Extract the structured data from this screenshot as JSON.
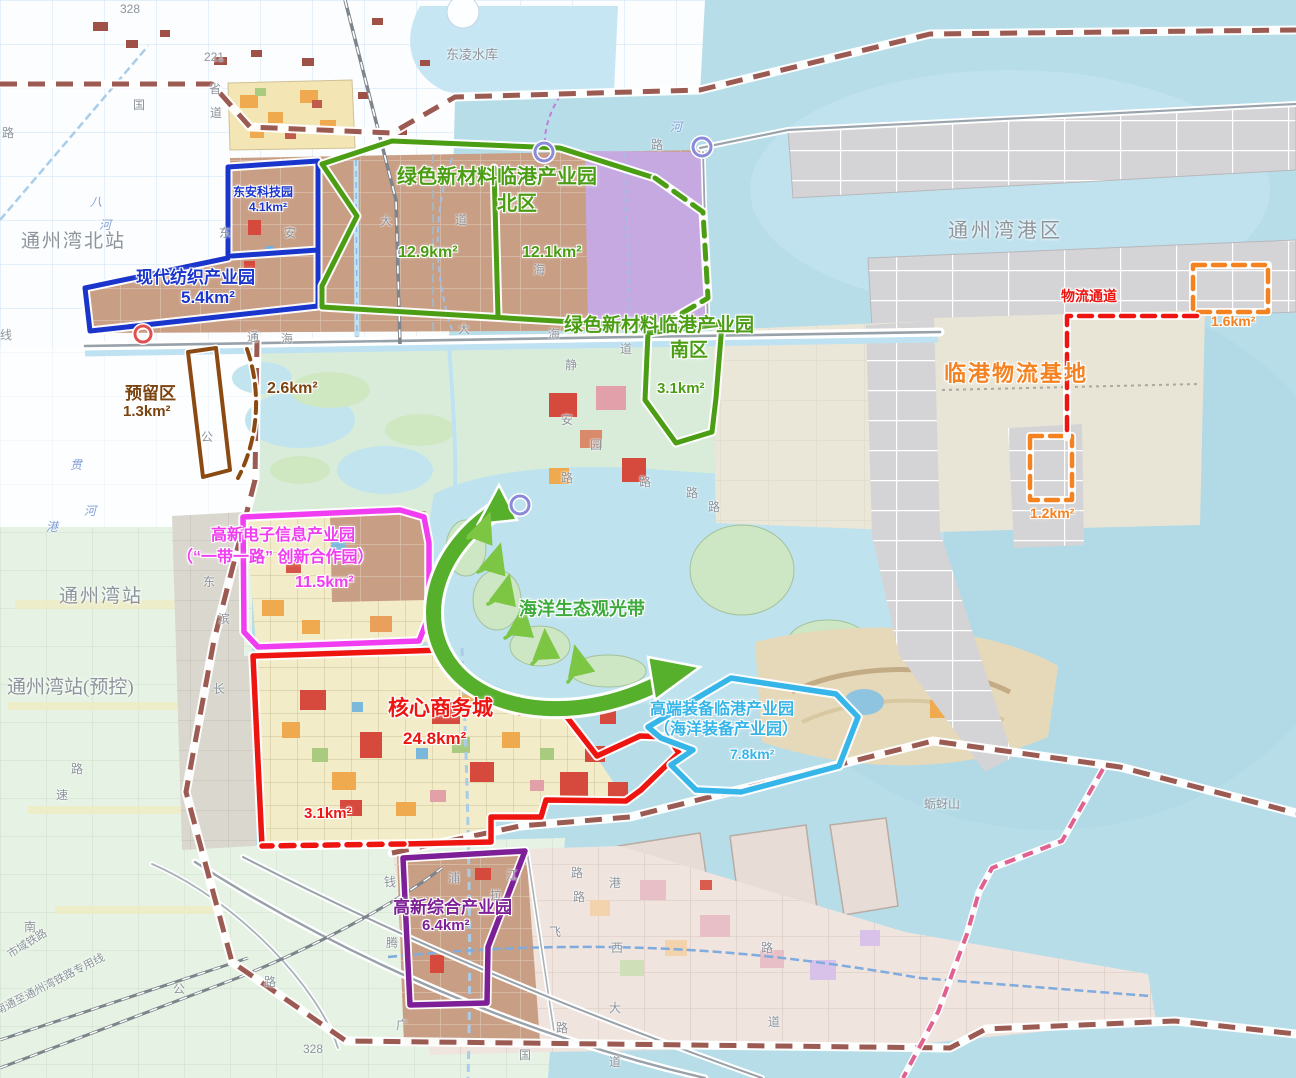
{
  "regions": {
    "dongan": {
      "name": "东安科技园",
      "area": "4.1km²"
    },
    "fangzhi": {
      "name": "现代纺织产业园",
      "area": "5.4km²"
    },
    "lvxin_bei": {
      "name": "绿色新材料临港产业园",
      "sub": "北区",
      "area_west": "12.9km²",
      "area_east": "12.1km²"
    },
    "lvxin_nan": {
      "name": "绿色新材料临港产业园",
      "sub": "南区",
      "area": "3.1km²"
    },
    "yuliu": {
      "name": "预留区",
      "area": "1.3km²",
      "area2": "2.6km²"
    },
    "dianzi": {
      "name": "高新电子信息产业园",
      "sub": "（“一带一路” 创新合作园）",
      "area": "11.5km²"
    },
    "hexin": {
      "name": "核心商务城",
      "area": "24.8km²",
      "area2": "3.1km²"
    },
    "zhuangbei": {
      "name": "高端装备临港产业园",
      "sub": "（海洋装备产业园）",
      "area": "7.8km²"
    },
    "zonghe": {
      "name": "高新综合产业园",
      "area": "6.4km²"
    },
    "wuliu": {
      "name": "临港物流基地",
      "corridor": "物流通道",
      "area_north": "1.6km²",
      "area_south": "1.2km²"
    }
  },
  "places": {
    "tzw_north_station": "通州湾北站",
    "tzw_station": "通州湾站",
    "tzw_station_reserved": "通州湾站(预控)",
    "tzw_port": "通州湾港区",
    "reservoir": "东凌水库",
    "island": "蛎蚜山",
    "belt": "海洋生态观光带"
  },
  "railways": {
    "r1": "市域铁路",
    "r2": "南通至通州湾铁路专用线"
  },
  "palette": {
    "blue": "#1a35cc",
    "green": "#4b9d14",
    "brown": "#8a4a12",
    "magenta": "#f13df1",
    "red": "#ee1511",
    "cyan": "#35b5e8",
    "purple": "#7d1f96",
    "orange": "#f58220",
    "belt_green": "#56b02b",
    "sea": "#b7dde9",
    "industrial_tan": "#c89e85",
    "lavender": "#c7a9e2"
  },
  "road_labels": [
    {
      "t": "328",
      "x": 120,
      "y": 2
    },
    {
      "t": "221",
      "x": 204,
      "y": 50
    },
    {
      "t": "国",
      "x": 133,
      "y": 96
    },
    {
      "t": "省",
      "x": 209,
      "y": 80
    },
    {
      "t": "道",
      "x": 210,
      "y": 104
    },
    {
      "t": "路",
      "x": 2,
      "y": 124
    },
    {
      "t": "线",
      "x": 0,
      "y": 326
    },
    {
      "t": "八",
      "x": 90,
      "y": 193,
      "c": "b"
    },
    {
      "t": "河",
      "x": 99,
      "y": 216,
      "c": "b"
    },
    {
      "t": "通",
      "x": 247,
      "y": 328
    },
    {
      "t": "海",
      "x": 281,
      "y": 330
    },
    {
      "t": "大",
      "x": 458,
      "y": 320
    },
    {
      "t": "海",
      "x": 548,
      "y": 325
    },
    {
      "t": "道",
      "x": 620,
      "y": 340
    },
    {
      "t": "东",
      "x": 219,
      "y": 224
    },
    {
      "t": "安",
      "x": 284,
      "y": 224
    },
    {
      "t": "大",
      "x": 380,
      "y": 212
    },
    {
      "t": "道",
      "x": 455,
      "y": 211
    },
    {
      "t": "海",
      "x": 533,
      "y": 261
    },
    {
      "t": "静",
      "x": 565,
      "y": 356
    },
    {
      "t": "安",
      "x": 561,
      "y": 411
    },
    {
      "t": "园",
      "x": 590,
      "y": 436
    },
    {
      "t": "路",
      "x": 561,
      "y": 469
    },
    {
      "t": "路",
      "x": 639,
      "y": 473
    },
    {
      "t": "路",
      "x": 686,
      "y": 484
    },
    {
      "t": "路",
      "x": 708,
      "y": 498
    },
    {
      "t": "公",
      "x": 201,
      "y": 428
    },
    {
      "t": "贯",
      "x": 70,
      "y": 456,
      "c": "b"
    },
    {
      "t": "河",
      "x": 84,
      "y": 502,
      "c": "b"
    },
    {
      "t": "港",
      "x": 46,
      "y": 518,
      "c": "b"
    },
    {
      "t": "河",
      "x": 670,
      "y": 118,
      "c": "b"
    },
    {
      "t": "路",
      "x": 651,
      "y": 136
    },
    {
      "t": "东",
      "x": 203,
      "y": 573
    },
    {
      "t": "滨",
      "x": 218,
      "y": 610
    },
    {
      "t": "长",
      "x": 213,
      "y": 680
    },
    {
      "t": "路",
      "x": 71,
      "y": 760
    },
    {
      "t": "速",
      "x": 56,
      "y": 786
    },
    {
      "t": "南",
      "x": 24,
      "y": 918
    },
    {
      "t": "公",
      "x": 173,
      "y": 980
    },
    {
      "t": "路",
      "x": 264,
      "y": 973
    },
    {
      "t": "328",
      "x": 303,
      "y": 1042
    },
    {
      "t": "钱",
      "x": 384,
      "y": 873
    },
    {
      "t": "浦",
      "x": 448,
      "y": 869
    },
    {
      "t": "江",
      "x": 506,
      "y": 866
    },
    {
      "t": "拉",
      "x": 490,
      "y": 886
    },
    {
      "t": "腾",
      "x": 386,
      "y": 934
    },
    {
      "t": "广",
      "x": 396,
      "y": 1016
    },
    {
      "t": "路",
      "x": 571,
      "y": 864
    },
    {
      "t": "路",
      "x": 573,
      "y": 888
    },
    {
      "t": "港",
      "x": 609,
      "y": 874
    },
    {
      "t": "飞",
      "x": 549,
      "y": 923
    },
    {
      "t": "西",
      "x": 611,
      "y": 939
    },
    {
      "t": "大",
      "x": 609,
      "y": 999
    },
    {
      "t": "路",
      "x": 556,
      "y": 1019
    },
    {
      "t": "道",
      "x": 609,
      "y": 1053
    },
    {
      "t": "国",
      "x": 519,
      "y": 1046
    },
    {
      "t": "路",
      "x": 761,
      "y": 939
    },
    {
      "t": "道",
      "x": 768,
      "y": 1013
    }
  ]
}
